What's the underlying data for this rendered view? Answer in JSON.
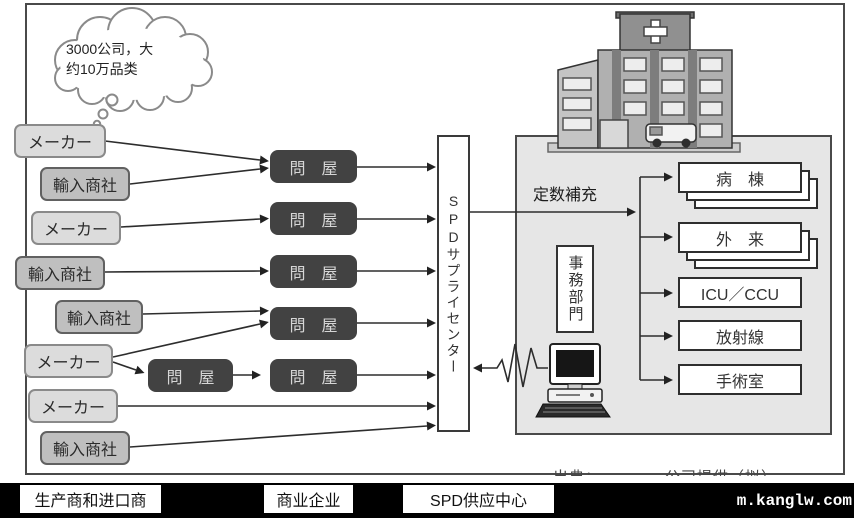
{
  "cloud": {
    "line1": "3000公司，大",
    "line2": "约10万品类"
  },
  "left_boxes": [
    {
      "label": "メーカー"
    },
    {
      "label": "輸入商社"
    },
    {
      "label": "メーカー"
    },
    {
      "label": "輸入商社"
    },
    {
      "label": "輸入商社"
    },
    {
      "label": "メーカー"
    },
    {
      "label": "メーカー"
    },
    {
      "label": "輸入商社"
    }
  ],
  "wholesaler_label": "問　屋",
  "spd_center_label": "SPDサプライセンター",
  "hospital": {
    "replenish_label": "定数補充",
    "admin_dept_label": "事務部門",
    "departments": [
      "病　棟",
      "外　来",
      "ICU／CCU",
      "放射線",
      "手術室"
    ]
  },
  "caption_partial": "出典：…………公司提供（拟）",
  "legend": [
    "生产商和进口商",
    "商业企业",
    "SPD供应中心"
  ],
  "watermark": "m.kanglw.com",
  "colors": {
    "wholesaler_bg": "#424242",
    "panel_bg": "#e6e6e6",
    "maker_bg": "#dcdcdc",
    "importer_bg": "#bfbfbf",
    "bottom_bar_bg": "#000000"
  }
}
